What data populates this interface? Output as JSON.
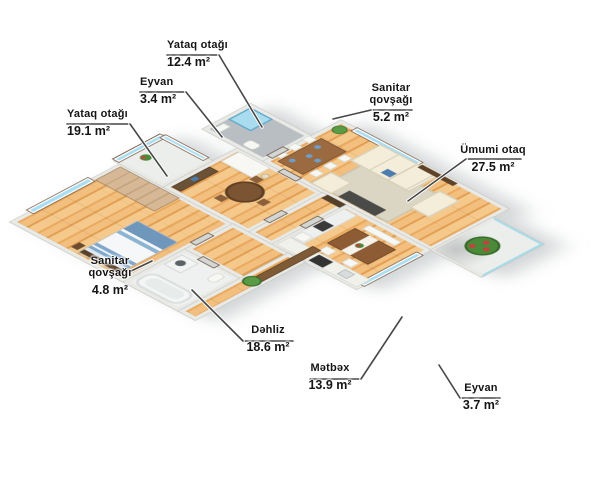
{
  "title": "Mənzil planı 3D",
  "units": "m²",
  "palette": {
    "wall": "#e9e9e5",
    "wood_floor": "#f0bd7b",
    "glass_blue": "#a9ddf1",
    "railing_cyan": "#a5dcea",
    "leader_line": "#474747",
    "plant_green": "#4a8a38",
    "flower_red": "#c84040",
    "sofa_cream": "#f3edda",
    "table_brown": "#8d5c35"
  },
  "rooms": [
    {
      "id": "bedroom-small",
      "name": "Yataq otağı",
      "area": "12.4 m²",
      "label": {
        "x": 167,
        "y": 39,
        "align": "left",
        "wrap": false,
        "rule": [
          167,
          55,
          219,
          55
        ],
        "leader": [
          [
            219,
            55
          ],
          [
            262,
            127
          ]
        ]
      }
    },
    {
      "id": "balcony-north",
      "name": "Eyvan",
      "area": "3.4 m²",
      "label": {
        "x": 140,
        "y": 76,
        "align": "left",
        "wrap": false,
        "rule": [
          140,
          92,
          186,
          92
        ],
        "leader": [
          [
            186,
            92
          ],
          [
            222,
            137
          ]
        ]
      }
    },
    {
      "id": "bedroom-big",
      "name": "Yataq otağı",
      "area": "19.1 m²",
      "label": {
        "x": 67,
        "y": 108,
        "align": "left",
        "wrap": false,
        "rule": [
          67,
          124,
          130,
          124
        ],
        "leader": [
          [
            130,
            124
          ],
          [
            167,
            176
          ]
        ]
      }
    },
    {
      "id": "bathroom-big",
      "name": "Sanitar qovşağı",
      "area": "5.2 m²",
      "label": {
        "x": 391,
        "y": 82,
        "align": "center",
        "wrap": true,
        "rule": [
          371,
          110,
          412,
          110
        ],
        "leader": [
          [
            371,
            110
          ],
          [
            333,
            119
          ]
        ]
      }
    },
    {
      "id": "living-room",
      "name": "Ümumi otaq",
      "area": "27.5 m²",
      "label": {
        "x": 493,
        "y": 144,
        "align": "center",
        "wrap": false,
        "rule": [
          466,
          159,
          521,
          159
        ],
        "leader": [
          [
            466,
            159
          ],
          [
            408,
            201
          ]
        ]
      }
    },
    {
      "id": "bathroom-small",
      "name": "Sanitar qovşağı",
      "area": "4.8 m²",
      "label": {
        "x": 110,
        "y": 255,
        "align": "center",
        "wrap": true,
        "rule": null,
        "leader": [
          [
            129,
            272
          ],
          [
            152,
            261
          ]
        ]
      }
    },
    {
      "id": "hallway",
      "name": "Dəhliz",
      "area": "18.6 m²",
      "label": {
        "x": 268,
        "y": 324,
        "align": "center",
        "wrap": false,
        "rule": [
          243,
          341,
          293,
          341
        ],
        "leader": [
          [
            243,
            341
          ],
          [
            192,
            290
          ]
        ]
      }
    },
    {
      "id": "kitchen",
      "name": "Mətbəx",
      "area": "13.9 m²",
      "label": {
        "x": 330,
        "y": 362,
        "align": "center",
        "wrap": false,
        "rule": [
          310,
          379,
          361,
          379
        ],
        "leader": [
          [
            361,
            379
          ],
          [
            402,
            317
          ]
        ]
      }
    },
    {
      "id": "balcony-south",
      "name": "Eyvan",
      "area": "3.7 m²",
      "label": {
        "x": 481,
        "y": 382,
        "align": "center",
        "wrap": false,
        "rule": [
          460,
          398,
          500,
          398
        ],
        "leader": [
          [
            460,
            398
          ],
          [
            439,
            365
          ]
        ]
      }
    }
  ]
}
